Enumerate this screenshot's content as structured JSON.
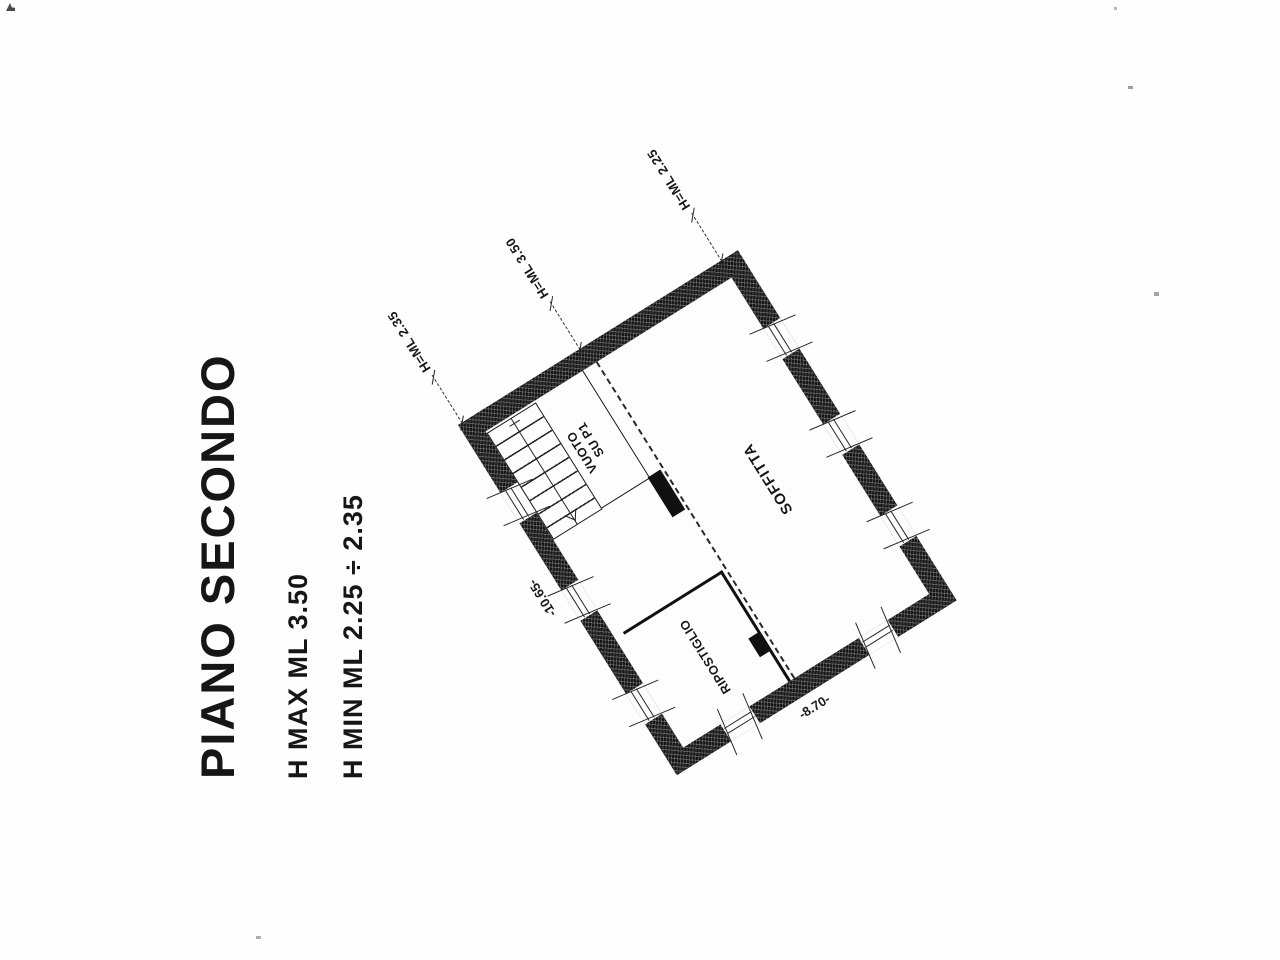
{
  "header": {
    "title": "PIANO SECONDO",
    "h_max": "H MAX ML 3.50",
    "h_min": "H MIN ML 2.25 ÷ 2.35"
  },
  "plan": {
    "rooms": {
      "soffitta": "SOFFITTA",
      "ripostiglio": "RIPOSTIGLIO",
      "vuoto": {
        "line1": "VUOTO",
        "line2": "SU P1"
      }
    },
    "height_labels": {
      "left_eave": "H=ML 2.35",
      "ridge": "H=ML 3.50",
      "right_eave": "H=ML 2.25"
    },
    "dimensions": {
      "side": "-10.65-",
      "bottom": "-8.70-"
    }
  }
}
